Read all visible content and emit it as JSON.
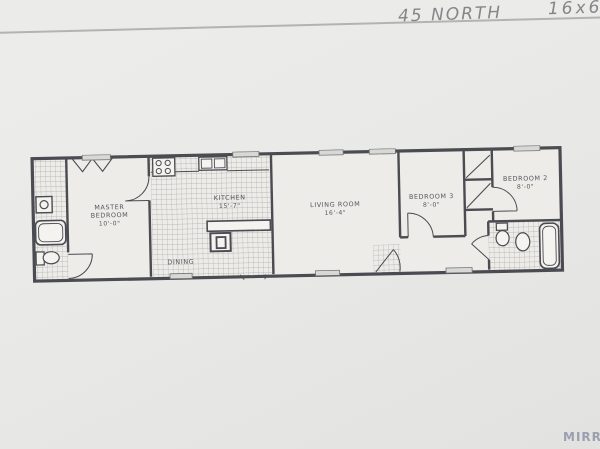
{
  "page": {
    "handwriting": {
      "model_text": "45 NORTH",
      "size_text": "16x66"
    },
    "footer_partial_text": "MIRRO"
  },
  "floor_plan": {
    "rooms": {
      "master_bedroom": {
        "line1": "MASTER",
        "line2": "BEDROOM",
        "dim": "10'-0\""
      },
      "kitchen": {
        "name": "KITCHEN",
        "dim": "15'-7\""
      },
      "dining": {
        "name": "DINING"
      },
      "living_room": {
        "name": "LIVING ROOM",
        "dim": "16'-4\""
      },
      "bedroom_3": {
        "name": "BEDROOM 3",
        "dim": "8'-0\""
      },
      "bedroom_2": {
        "name": "BEDROOM 2",
        "dim": "8'-0\""
      }
    },
    "colors": {
      "wall": "#4b4b52",
      "label": "#54545e",
      "tile_line": "#a6a6a2",
      "paper": "#edece8",
      "window_fill": "#d8d8d4"
    }
  }
}
